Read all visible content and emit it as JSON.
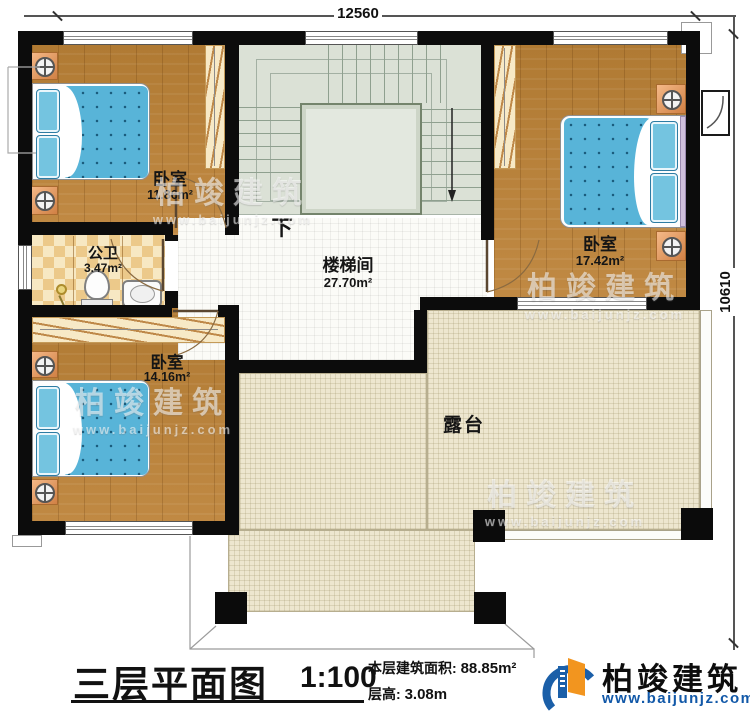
{
  "plan": {
    "title": "三层平面图",
    "scale": "1:100",
    "floor_area_label": "本层建筑面积:",
    "floor_area_value": "88.85m²",
    "floor_height_label": "层高:",
    "floor_height_value": "3.08m"
  },
  "dimensions": {
    "width_mm": "12560",
    "height_mm": "10610"
  },
  "rooms": [
    {
      "name": "卧室",
      "area": "11.86m²"
    },
    {
      "name": "公卫",
      "area": "3.47m²"
    },
    {
      "name": "楼梯间",
      "area": "27.70m²"
    },
    {
      "name": "卧室",
      "area": "17.42m²"
    },
    {
      "name": "卧室",
      "area": "14.16m²"
    },
    {
      "name": "露台",
      "area": ""
    }
  ],
  "stairs": {
    "direction_label": "下"
  },
  "brand": {
    "name": "柏竣建筑",
    "website": "www.baijunjz.com"
  },
  "watermark": {
    "name": "柏竣建筑",
    "website": "www.baijunjz.com"
  },
  "colors": {
    "wall": "#0c0c0c",
    "wood_floor": "#b5803a",
    "terrace_tile": "#ede6cf",
    "stair_floor": "#dbe1d6",
    "bed_blue": "#58b4d8",
    "brand_blue": "#1158a8",
    "brand_orange": "#f2951f"
  }
}
